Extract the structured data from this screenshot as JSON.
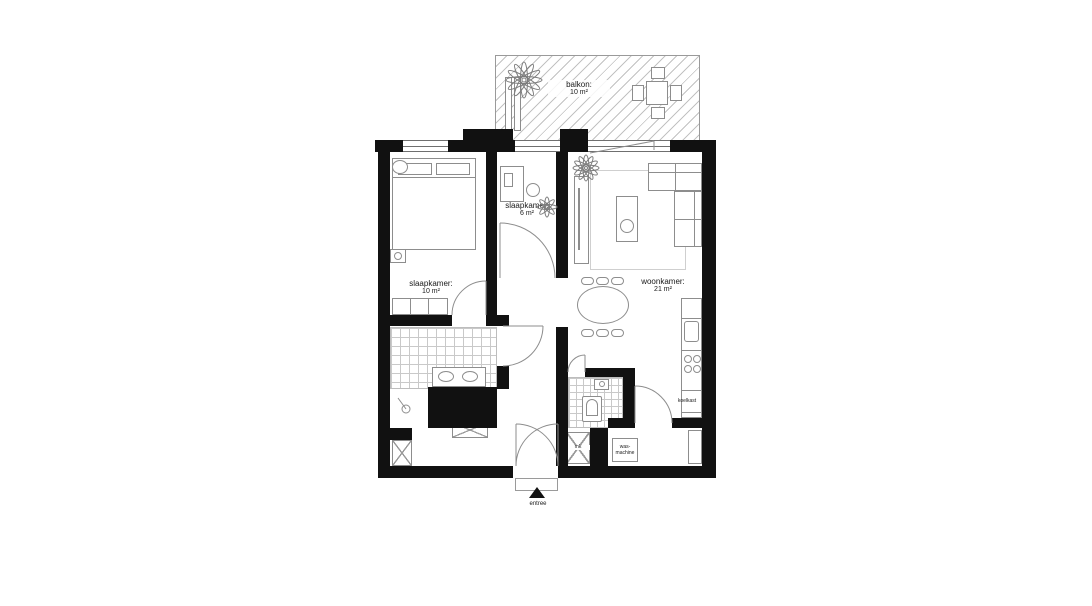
{
  "floorplan": {
    "rooms": [
      {
        "id": "balcony",
        "label": "balkon:",
        "area": "10 m²"
      },
      {
        "id": "bedroom-small",
        "label": "slaapkamer:",
        "area": "6 m²"
      },
      {
        "id": "bedroom-main",
        "label": "slaapkamer:",
        "area": "10 m²"
      },
      {
        "id": "living-room",
        "label": "woonkamer:",
        "area": "21 m²"
      }
    ],
    "annotations": {
      "fridge": "koelkast",
      "washing_machine_line1": "was-",
      "washing_machine_line2": "machine",
      "meter_cupboard": "mk",
      "entrance": "entree"
    },
    "colors": {
      "wall": "#111111",
      "furniture_outline": "#8d8d8d",
      "tile_line": "#c9c9c9",
      "hatch_line": "#c2c2c2",
      "text": "#1a1a1a",
      "background": "#ffffff"
    }
  }
}
